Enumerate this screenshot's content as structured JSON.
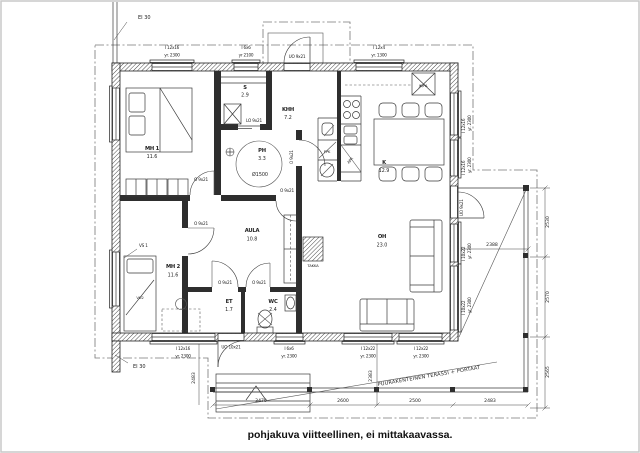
{
  "labels": {
    "ei30": "EI 30",
    "terrace": "PUURAKENTEINEN TERASSI + PORTAAT",
    "caption": "pohjakuva viitteellinen, ei mittakaavassa."
  },
  "rooms": {
    "mh1": {
      "name": "MH 1",
      "area": "11.6"
    },
    "s": {
      "name": "S",
      "area": "2.9"
    },
    "khh": {
      "name": "KHH",
      "area": "7.2"
    },
    "ph": {
      "name": "PH",
      "area": "3.3",
      "circle": "Ø1500"
    },
    "k": {
      "name": "K",
      "area": "12.9"
    },
    "aula": {
      "name": "AULA",
      "area": "10.8"
    },
    "oh": {
      "name": "OH",
      "area": "23.0"
    },
    "mh2": {
      "name": "MH 2",
      "area": "11.6"
    },
    "et": {
      "name": "ET",
      "area": "1.7"
    },
    "wc": {
      "name": "WC",
      "area": "2.4"
    }
  },
  "fixtures": {
    "takka": "TAKKA",
    "vu2": "VU2",
    "vs1": "VS 1",
    "ppk": "PPK",
    "apk": "APK",
    "jkpa": "JK/PA"
  },
  "openings": {
    "o921": "O 9x21",
    "lo921": "LO 9x21",
    "uo921": "UO 9x21",
    "uo1021": "UO 10x21",
    "w12x16": "I 12x16",
    "w6x6": "I 6x6",
    "w12x4": "I 12x4",
    "w10x22": "I 10x22",
    "w12x22": "I 12x22",
    "yr2300": "yr. 2300",
    "yr2100": "yr 2100",
    "yr1300": "yr. 1300"
  },
  "dims": {
    "d2388": "2388",
    "d2530": "2530",
    "d2570": "2570",
    "d2565": "2565",
    "d3470": "3470",
    "d2600": "2600",
    "d2500": "2500",
    "d2483": "2483",
    "d2383": "2383"
  }
}
